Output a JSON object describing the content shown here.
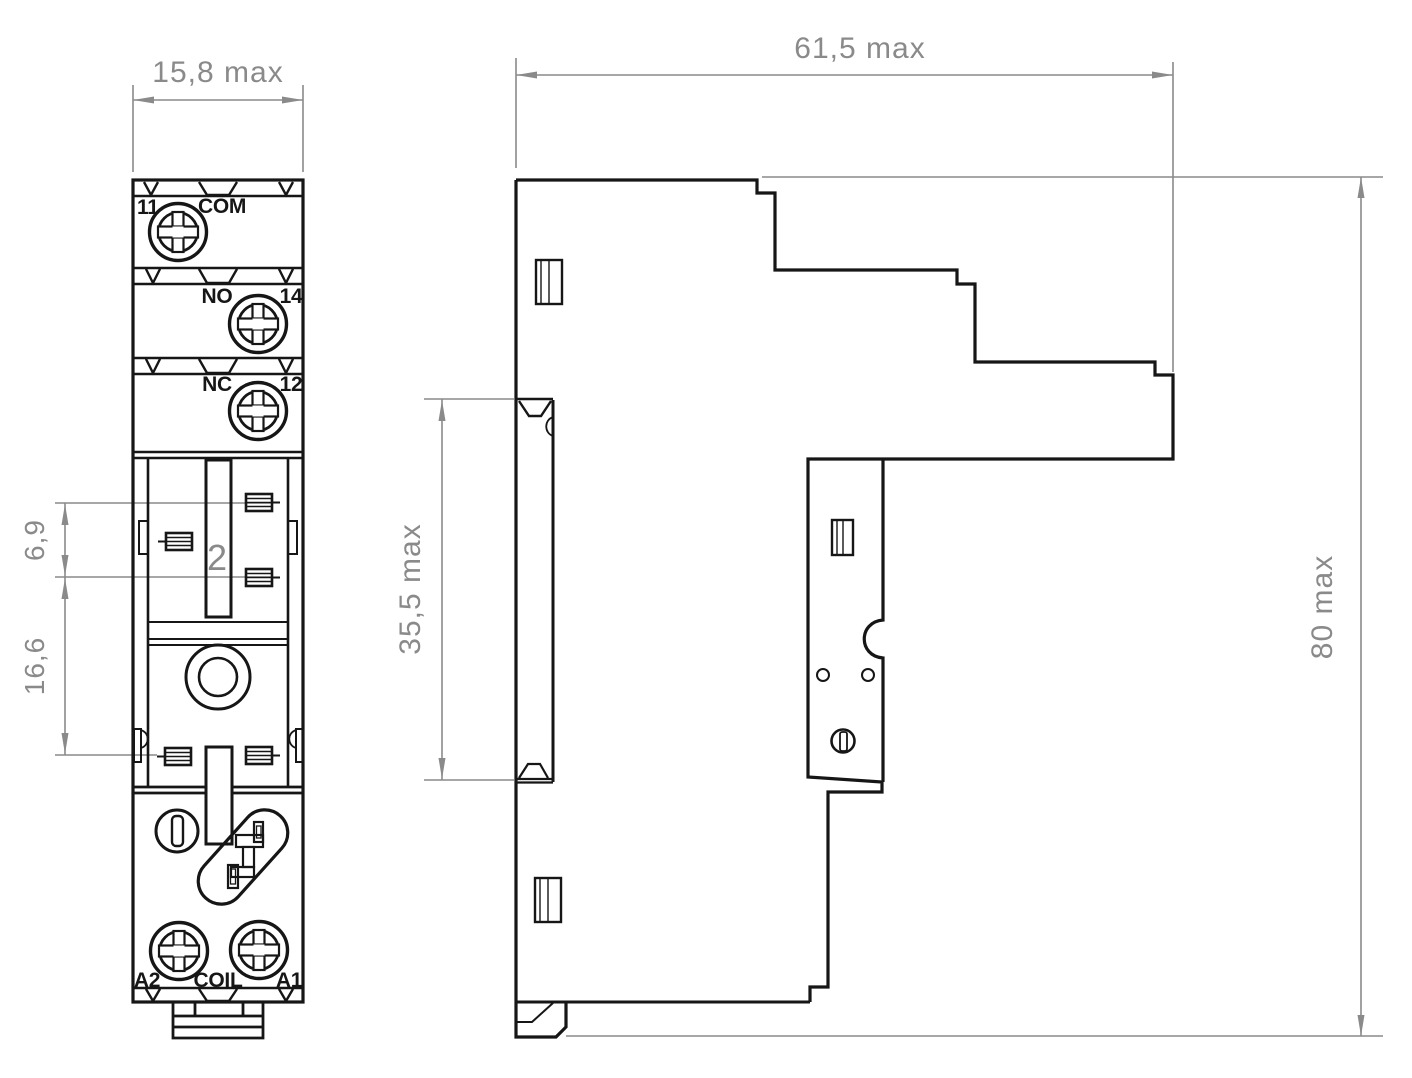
{
  "colors": {
    "line": "#161616",
    "dim": "#8a8a8a",
    "bg": "#ffffff"
  },
  "front_view": {
    "width_dim": "15,8 max",
    "pitch_dim": "6,9",
    "row_spacing_dim": "16,6",
    "terminals": {
      "com": {
        "number": "11",
        "name": "COM"
      },
      "no": {
        "name": "NO",
        "number": "14"
      },
      "nc": {
        "name": "NC",
        "number": "12"
      }
    },
    "marking": "2",
    "coil": {
      "left": "A2",
      "label": "COIL",
      "right": "A1"
    }
  },
  "side_view": {
    "width_dim": "61,5 max",
    "rail_section_dim": "35,5 max",
    "height_dim": "80 max"
  }
}
